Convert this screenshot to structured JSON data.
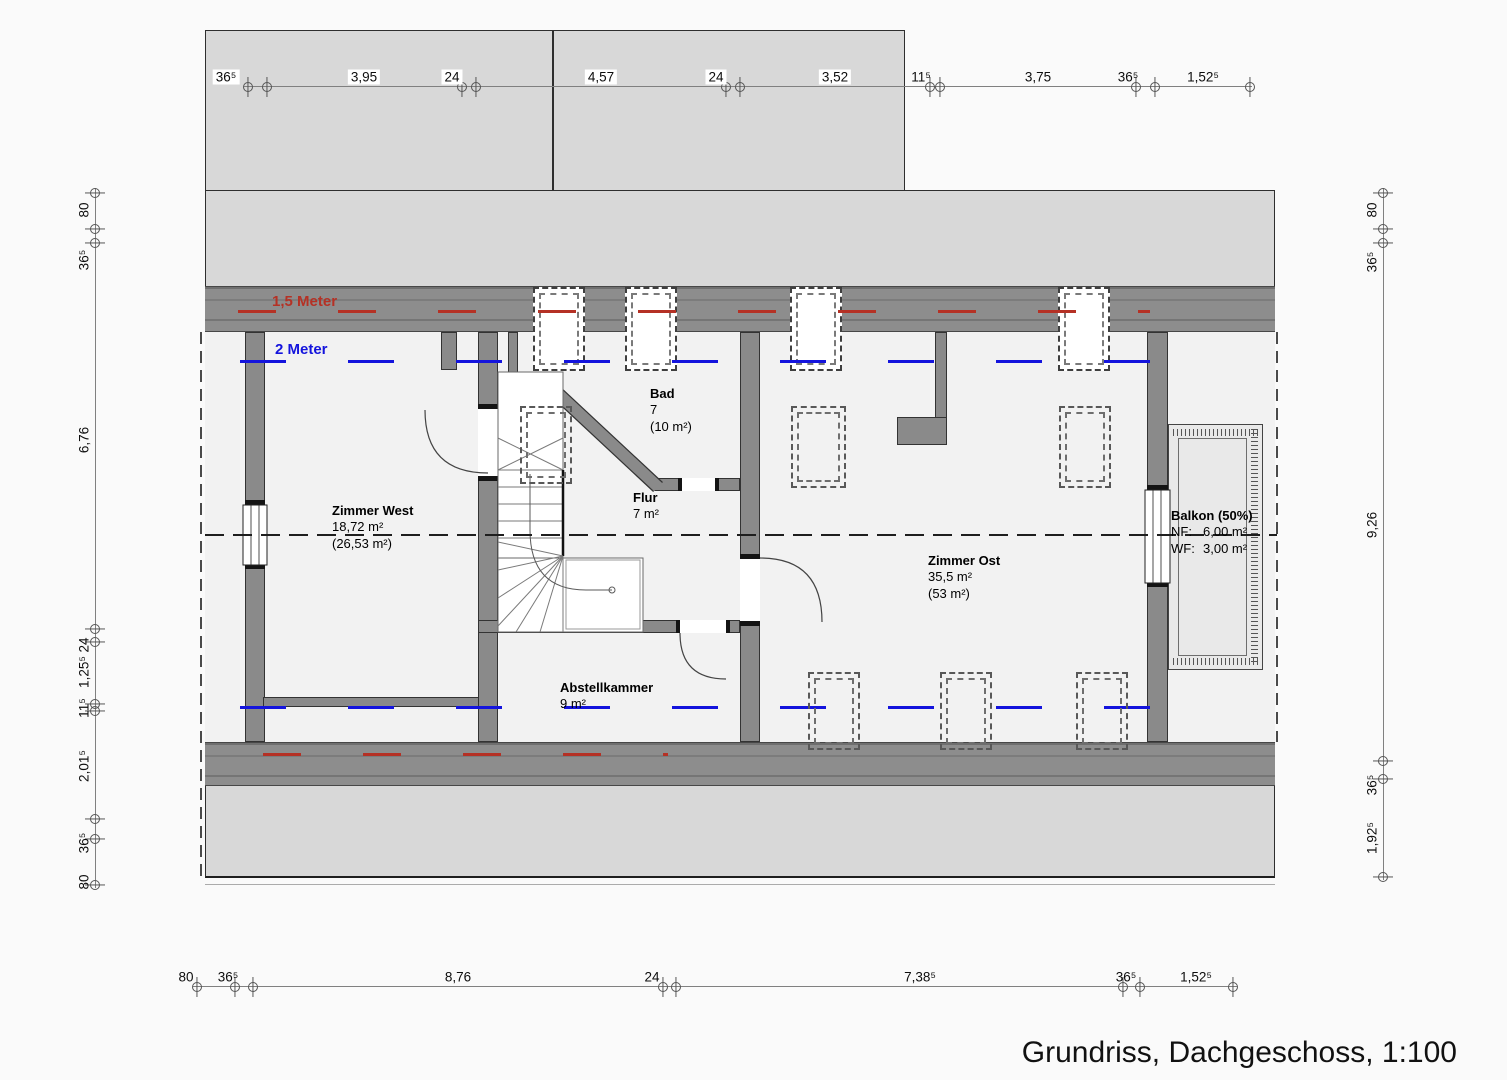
{
  "title": "Grundriss, Dachgeschoss, 1:100",
  "levels": {
    "red_label": "1,5 Meter",
    "red_color": "#b53125",
    "blue_label": "2 Meter",
    "blue_color": "#1414dd"
  },
  "rooms": {
    "zimmer_west": {
      "name": "Zimmer West",
      "area": "18,72 m²",
      "area_total": "(26,53 m²)"
    },
    "bad": {
      "name": "Bad",
      "area": "7",
      "area_total": "(10 m²)"
    },
    "flur": {
      "name": "Flur",
      "area": "7 m²"
    },
    "zimmer_ost": {
      "name": "Zimmer Ost",
      "area": "35,5 m²",
      "area_total": "(53 m²)"
    },
    "abstellkammer": {
      "name": "Abstellkammer",
      "area": "9 m²"
    },
    "balkon": {
      "name": "Balkon (50%)",
      "nf_label": "NF:",
      "nf_value": "6,00 m²",
      "wf_label": "WF:",
      "wf_value": "3,00 m²"
    }
  },
  "dimensions": {
    "top": [
      "36⁵",
      "3,95",
      "24",
      "4,57",
      "24",
      "3,52",
      "11⁵",
      "3,75",
      "36⁵",
      "1,52⁵"
    ],
    "bottom": [
      "80",
      "36⁵",
      "8,76",
      "24",
      "7,38⁵",
      "36⁵",
      "1,52⁵"
    ],
    "left": [
      "80",
      "36⁵",
      "6,76",
      "24",
      "1,25⁵",
      "11⁵",
      "2,01⁵",
      "36⁵",
      "80"
    ],
    "right": [
      "80",
      "36⁵",
      "9,26",
      "36⁵",
      "1,92⁵"
    ]
  }
}
